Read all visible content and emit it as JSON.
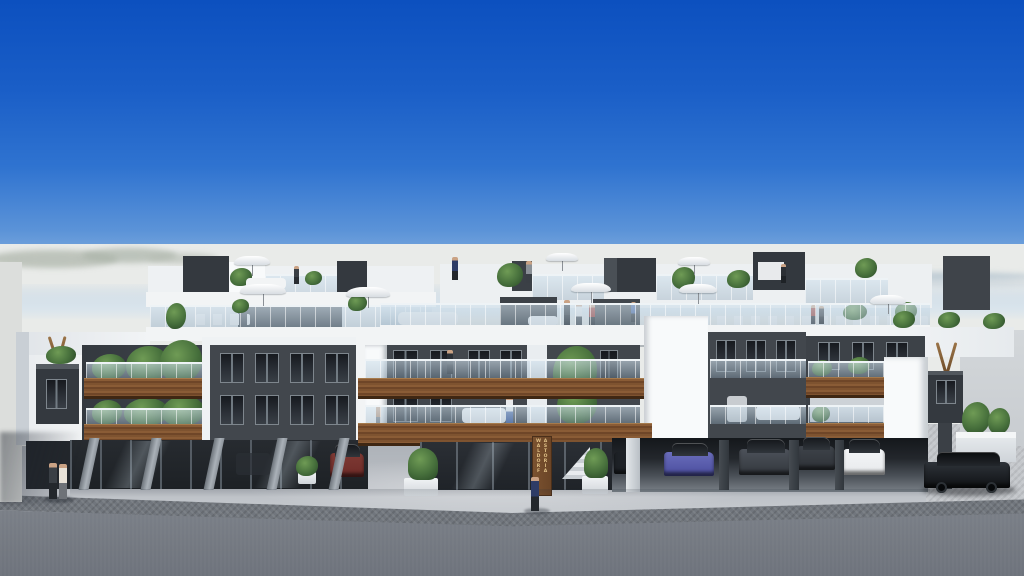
{
  "sign": {
    "column_left": "WALDORF",
    "column_right": "ASTORIA"
  },
  "palette": {
    "sky_top": "#0c50bf",
    "sky_mid": "#2f73d0",
    "sky_low": "#8fb6e0",
    "haze": "#e9ebe9",
    "hill_left": "#b3bab0",
    "hill_right": "#a9bcca",
    "white": "#f2f4f5",
    "white_bright": "#f8fafb",
    "white_shade": "#dde2e6",
    "white_deep": "#c2c9cf",
    "dark": "#42474d",
    "dark2": "#34393f",
    "win_dark": "#1b1f24",
    "wood": "#7e5330",
    "wood_dark": "#3f2713",
    "glass": "#cfe0ec",
    "plaza": "#b8bcc2",
    "plaza_light": "#ced2d6",
    "cobble": "#71767d",
    "cobble_light": "#c4c7cb",
    "road": "#7d828a",
    "road_dark": "#6e737c",
    "green": "#47703c",
    "green_dark": "#2e4f2a",
    "green_light": "#6f9b55",
    "sign_wood": "#6b4527",
    "sign_gold": "#e0c188",
    "car_blue": "#4a4d9e",
    "car_dark": "#33373d",
    "car_white": "#e7e9eb",
    "car_black": "#0f1114",
    "car_red": "#6e2b28",
    "pillar": "#9aa1a8"
  }
}
